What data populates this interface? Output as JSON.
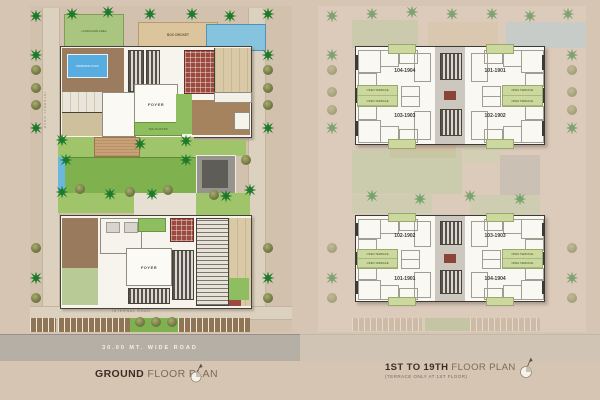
{
  "left_plan": {
    "title_bold": "GROUND",
    "title_rest": "FLOOR PLAN",
    "road_label": "30.00 MT. WIDE ROAD",
    "internal_road_label": "INTERNAL ROAD",
    "labels": {
      "landscape": "LANDSCAPE AREA",
      "box_cricket": "BOX CRICKET",
      "swimming_pool": "SWIMMING POOL",
      "foyer": "FOYER",
      "planter": "THE PLANTER"
    }
  },
  "right_plan": {
    "title_bold": "1ST TO 19TH",
    "title_rest": "FLOOR PLAN",
    "subtitle": "(TERRACE ONLY AT 1ST FLOOR)",
    "terrace_label": "OPEN TERRACE",
    "towers": [
      {
        "units": {
          "tl": "104-1904",
          "tr": "101-1901",
          "bl": "103-1903",
          "br": "102-1902"
        }
      },
      {
        "units": {
          "tl": "102-1902",
          "tr": "103-1903",
          "bl": "101-1901",
          "br": "104-1904"
        }
      }
    ]
  },
  "colors": {
    "lawn_green": "#7fb24f",
    "terrace_green": "#cbd99f",
    "pool_blue": "#57ace0",
    "maroon": "#9a4a3e",
    "road_grey": "#b5afa5"
  }
}
